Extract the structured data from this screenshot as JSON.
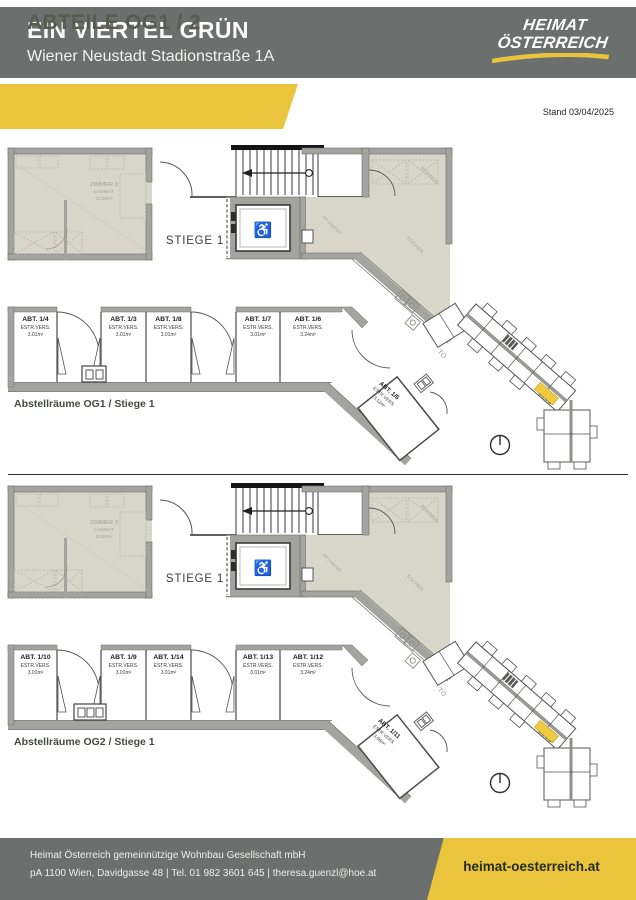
{
  "header": {
    "title": "EIN VIERTEL GRÜN",
    "subtitle": "Wiener Neustadt Stadionstraße 1A",
    "logo": {
      "line1": "HEIMAT",
      "line2": "ÖSTERREICH"
    },
    "banner": "ABTEILE OG1 / 2",
    "stand": "Stand 03/04/2025"
  },
  "colors": {
    "accent_yellow": "#e9c43c",
    "header_gray": "#6b6f6d",
    "plan_beige": "#d7d6c8",
    "wall_gray": "#a3a3a0",
    "keyplan_highlight": "#f0ca3e"
  },
  "plans": [
    {
      "caption": "Abstellräume OG1 / Stiege 1",
      "stiege": "STIEGE 1",
      "room": {
        "name": "ZIMMER 3",
        "floor": "LAMINAT",
        "area": "12.50m²"
      },
      "faint": {
        "wohnen": "WOHNEN",
        "kochen": "KOCHEN",
        "ar": "AR LAMINAT",
        "top": "TO"
      },
      "compartments": [
        {
          "name": "ABT. 1/4",
          "type": "ESTR.VERS.",
          "area": "3.01m²"
        },
        {
          "name": "ABT. 1/3",
          "type": "ESTR.VERS.",
          "area": "3.01m²"
        },
        {
          "name": "ABT. 1/8",
          "type": "ESTR.VERS.",
          "area": "3.01m²"
        },
        {
          "name": "ABT. 1/7",
          "type": "ESTR.VERS.",
          "area": "3.01m²"
        },
        {
          "name": "ABT. 1/6",
          "type": "ESTR.VERS.",
          "area": "3.24m²"
        }
      ],
      "diag": {
        "name": "ABT. 1/5",
        "type": "ESTR.VERS.",
        "area": "3.12m²"
      }
    },
    {
      "caption": "Abstellräume OG2 / Stiege 1",
      "stiege": "STIEGE 1",
      "room": {
        "name": "ZIMMER 3",
        "floor": "LAMINAT",
        "area": "12.50m²"
      },
      "faint": {
        "wohnen": "WOHNEN",
        "kochen": "KOCHEN",
        "ar": "AR LAMINAT",
        "top": "TO"
      },
      "compartments": [
        {
          "name": "ABT. 1/10",
          "type": "ESTR.VERS.",
          "area": "3.01m²"
        },
        {
          "name": "ABT. 1/9",
          "type": "ESTR.VERS.",
          "area": "3.01m²"
        },
        {
          "name": "ABT. 1/14",
          "type": "ESTR.VERS.",
          "area": "3.01m²"
        },
        {
          "name": "ABT. 1/13",
          "type": "ESTR.VERS.",
          "area": "3.01m²"
        },
        {
          "name": "ABT. 1/12",
          "type": "ESTR.VERS.",
          "area": "3.24m²"
        }
      ],
      "diag": {
        "name": "ABT. 1/11",
        "type": "ESTR.VERS.",
        "area": "3.08m²"
      }
    }
  ],
  "footer": {
    "company": "Heimat Österreich gemeinnützige Wohnbau Gesellschaft mbH",
    "contact": "pA 1100 Wien, Davidgasse 48   |   Tel. 01 982 3601 645   |   theresa.guenzl@hoe.at",
    "website": "heimat-oesterreich.at"
  }
}
